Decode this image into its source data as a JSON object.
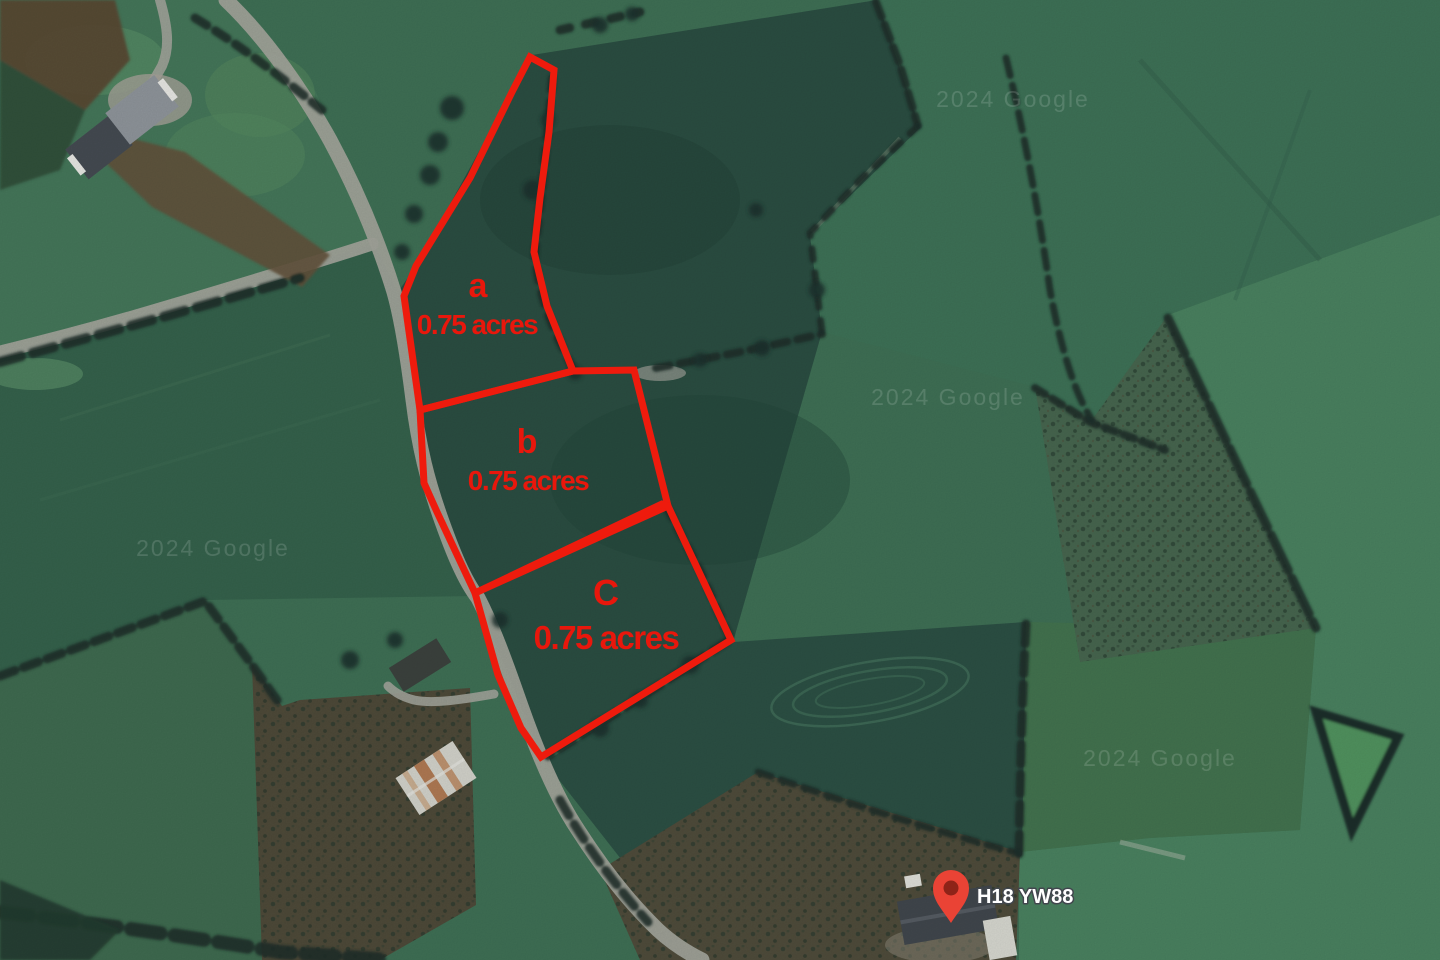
{
  "map": {
    "type": "satellite-aerial-view",
    "watermark": "2024 Google",
    "parcels": [
      {
        "id": "a",
        "label": "a",
        "area": "0.75 acres"
      },
      {
        "id": "b",
        "label": "b",
        "area": "0.75 acres"
      },
      {
        "id": "C",
        "label": "C",
        "area": "0.75 acres"
      }
    ],
    "pin": {
      "label": "H18 YW88",
      "pin_color": "#EA4335",
      "pin_inner_color": "#8E2318"
    },
    "overlay": {
      "color": "#ee1b0d"
    },
    "colors": {
      "field_green_dark": "#2b4e42",
      "field_green": "#3f7055",
      "field_green_bright": "#4a8260",
      "road_gray": "#a2a49b",
      "hedge_dark": "#1b2d2a",
      "label_red": "#e8170c",
      "pin_label_text": "#ffffff"
    }
  }
}
